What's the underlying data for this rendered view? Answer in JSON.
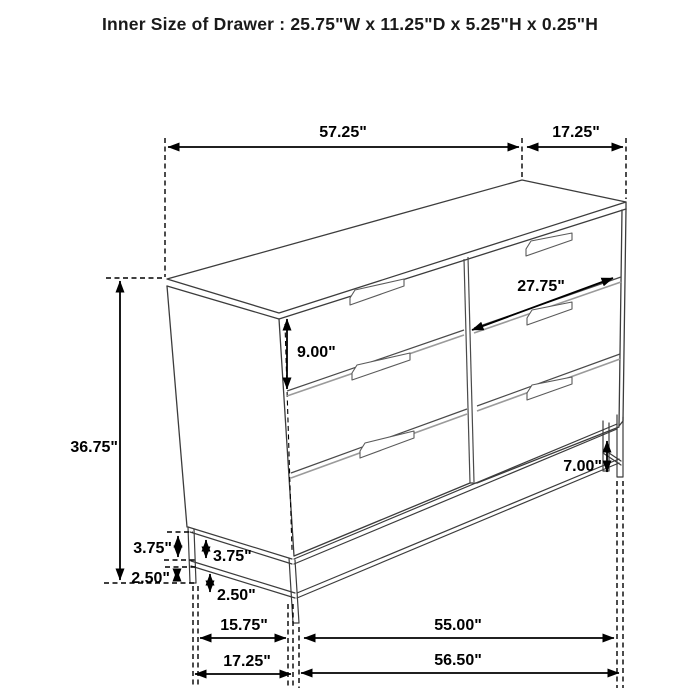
{
  "title": "Inner Size of Drawer : 25.75\"W x 11.25\"D x 5.25\"H x 0.25\"H",
  "diagram": {
    "type": "furniture-dimension-diagram",
    "item": "six-drawer dresser on metal base",
    "line_color": "#3c3c3c",
    "dimension_color": "#000000",
    "dimensions": {
      "overall_width": "57.25\"",
      "overall_depth": "17.25\"",
      "overall_height": "36.75\"",
      "drawer_front_width": "27.75\"",
      "top_drawer_height": "9.00\"",
      "right_leg_height": "7.00\"",
      "side_base_upper": "3.75\"",
      "front_base_upper": "3.75\"",
      "side_base_lower": "2.50\"",
      "front_base_lower": "2.50\"",
      "side_leg_span_inner": "15.75\"",
      "side_leg_span_outer": "17.25\"",
      "front_leg_span_inner": "55.00\"",
      "front_leg_span_outer": "56.50\""
    }
  }
}
